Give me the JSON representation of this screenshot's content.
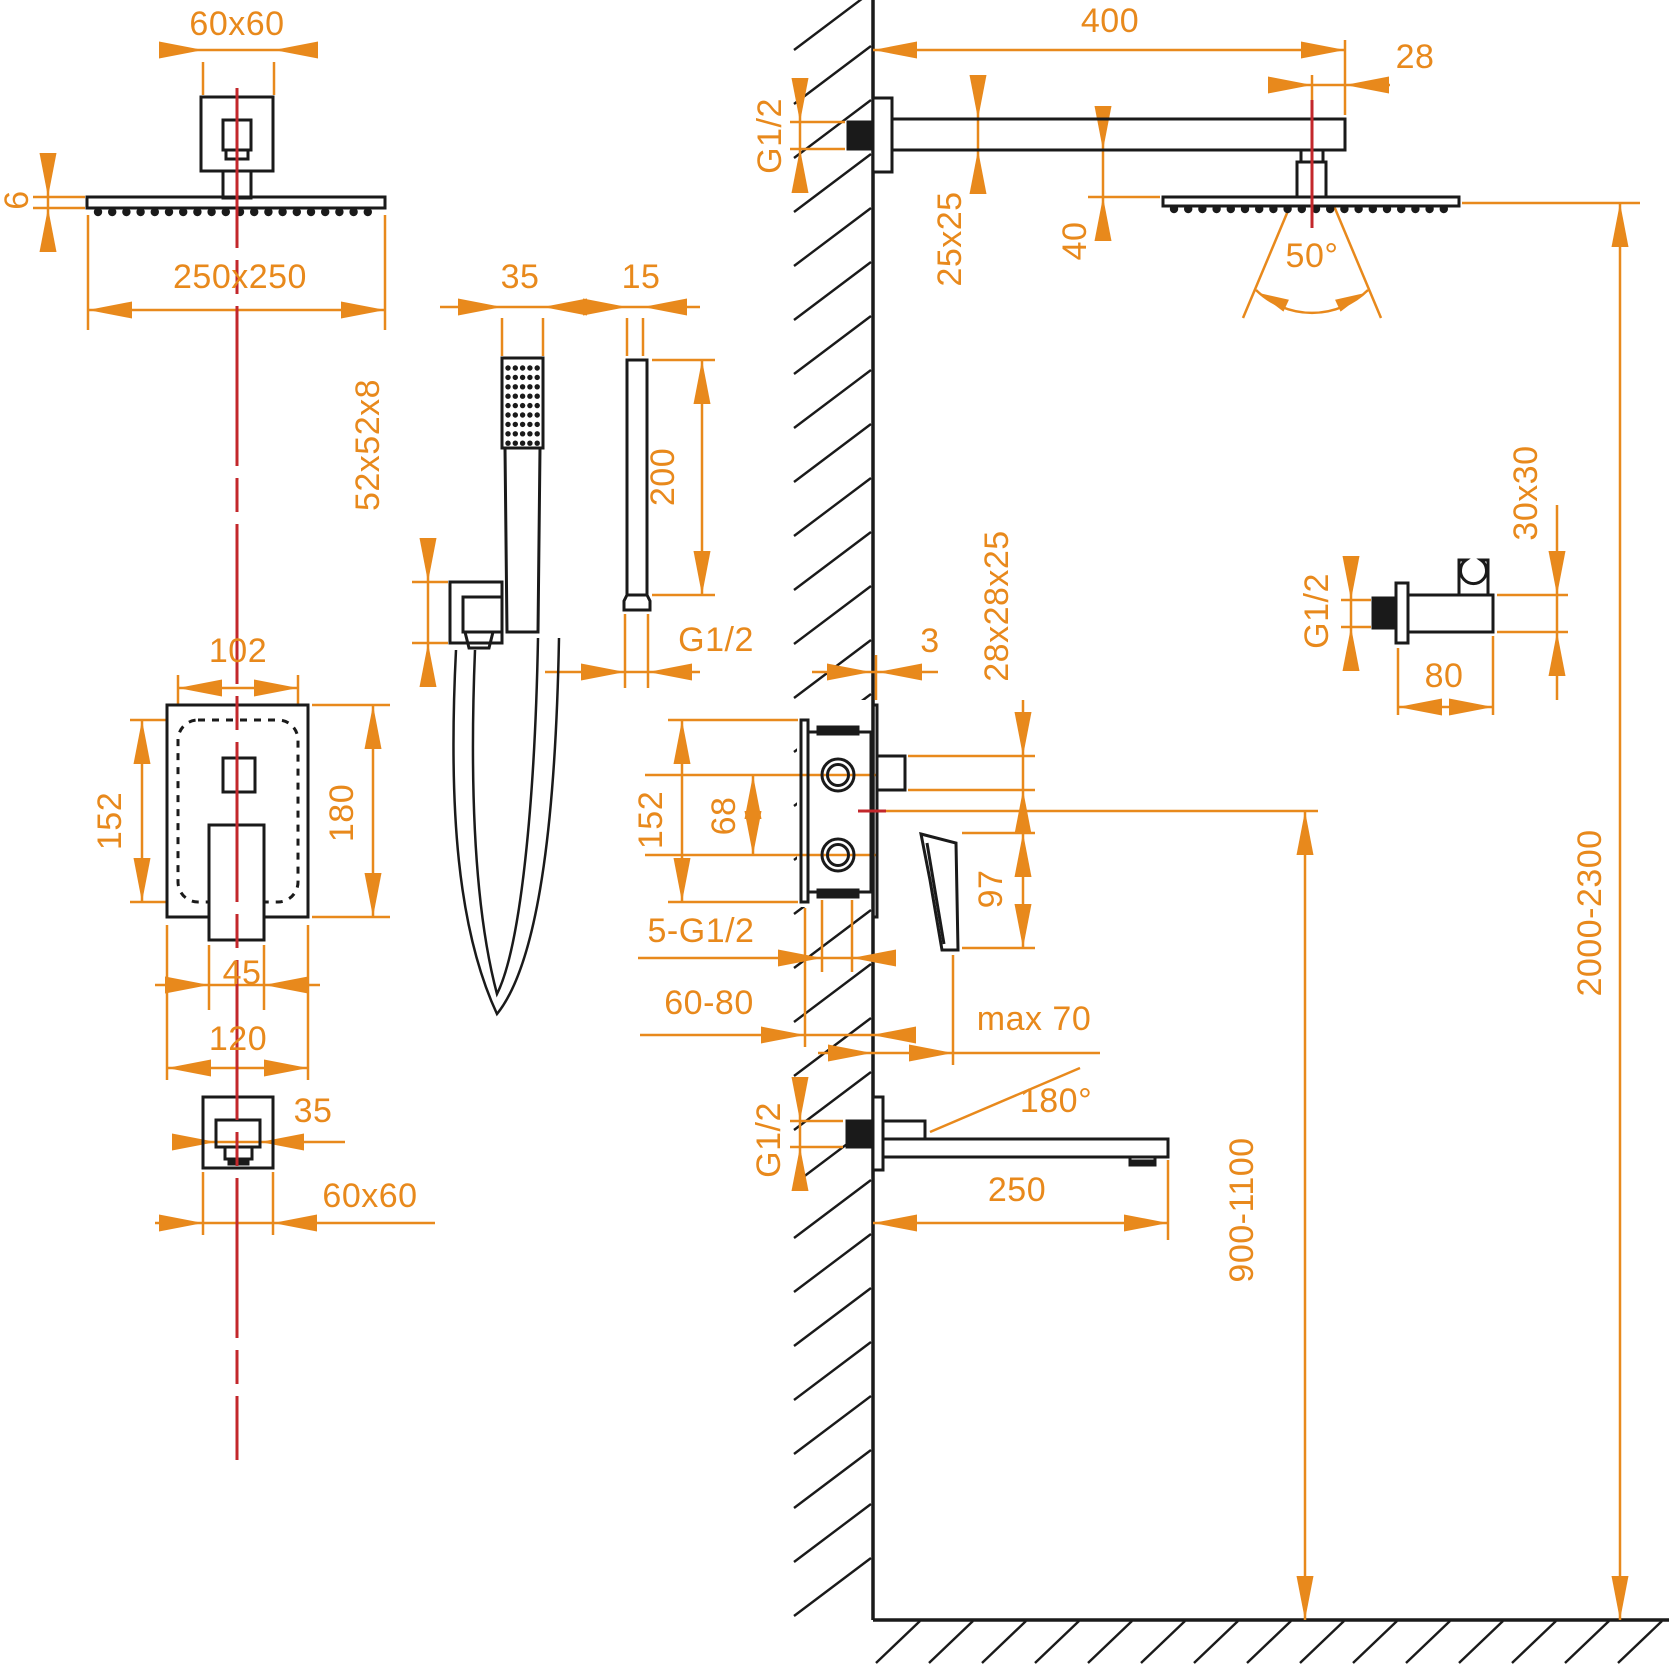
{
  "drawing": {
    "kind": "technical installation drawing - concealed shower set",
    "colors": {
      "dimension": "#E8891C",
      "centerline": "#C3272B",
      "outline": "#1A1A1A"
    }
  },
  "labels": {
    "t_60x60_top": "60x60",
    "t_6": "6",
    "t_250x250": "250x250",
    "t_35_hand": "35",
    "t_15": "15",
    "t_52x52x8": "52x52x8",
    "t_200": "200",
    "t_g12_hand": "G1/2",
    "t_102": "102",
    "t_152_front": "152",
    "t_180": "180",
    "t_45": "45",
    "t_120": "120",
    "t_35_spout": "35",
    "t_60x60_bot": "60x60",
    "t_400": "400",
    "t_28": "28",
    "t_g12_arm": "G1/2",
    "t_25x25": "25x25",
    "t_40": "40",
    "t_50": "50°",
    "t_3": "3",
    "t_28x28x25": "28x28x25",
    "t_30x30": "30x30",
    "t_g12_holder": "G1/2",
    "t_80": "80",
    "t_152_side": "152",
    "t_68": "68",
    "t_97": "97",
    "t_5g12": "5-G1/2",
    "t_6080": "60-80",
    "t_max70": "max 70",
    "t_g12_spout": "G1/2",
    "t_180deg": "180°",
    "t_250": "250",
    "t_9001100": "900-1100",
    "t_20002300": "2000-2300"
  }
}
